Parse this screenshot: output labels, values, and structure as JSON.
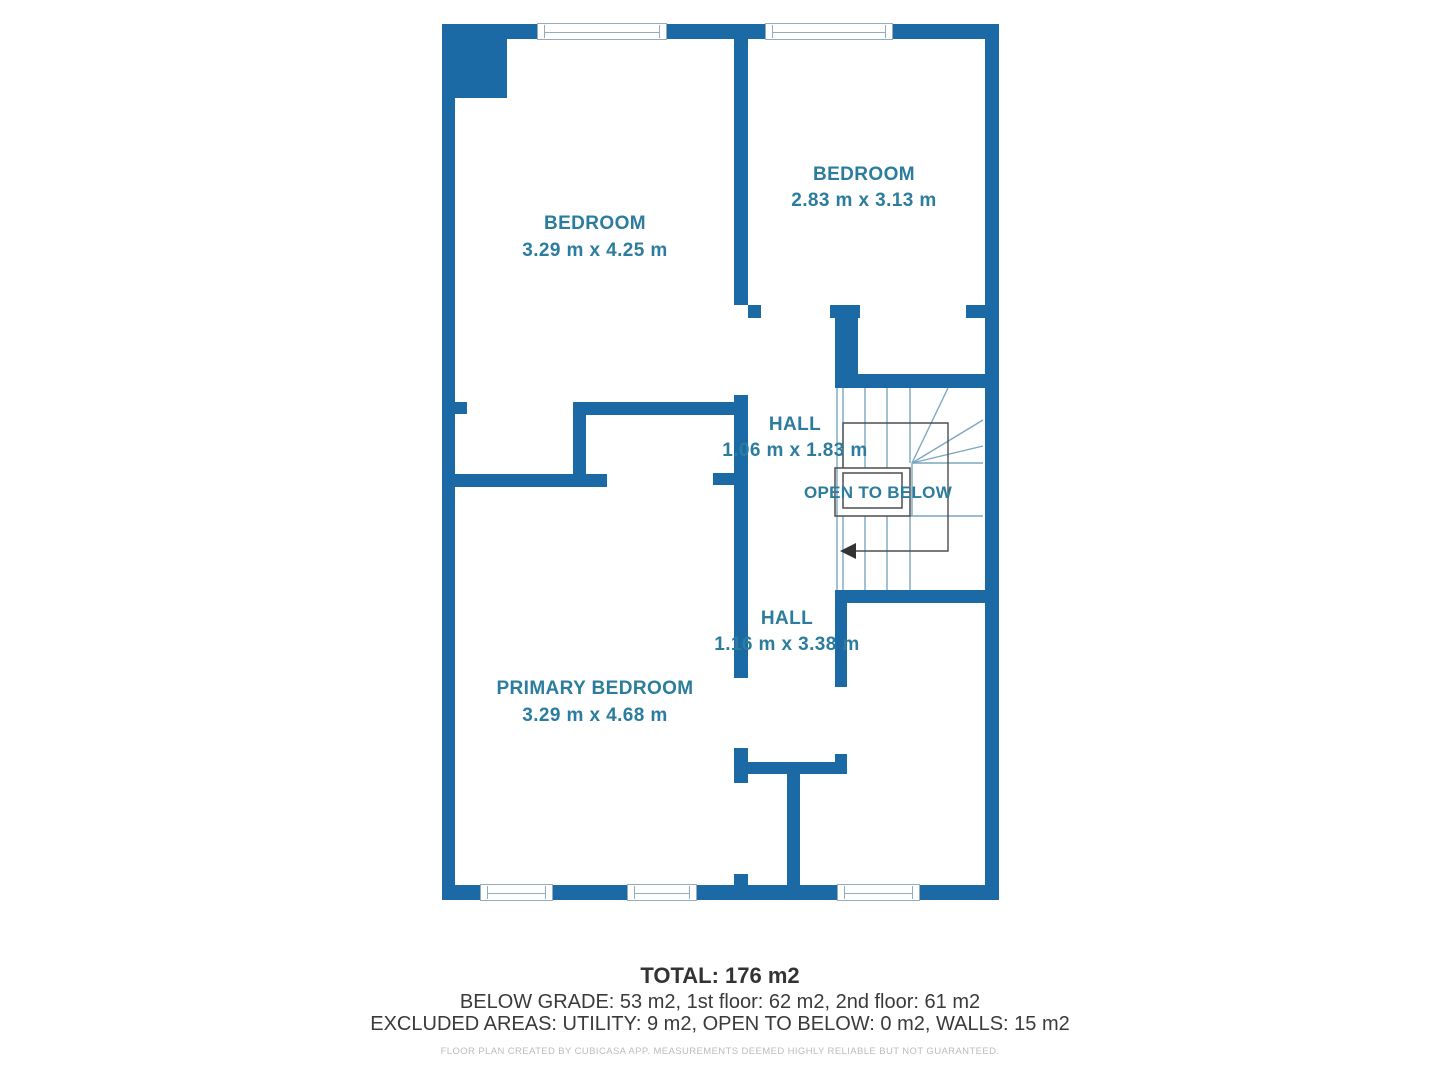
{
  "plan": {
    "rooms": [
      {
        "id": "bedroom-left",
        "name": "BEDROOM",
        "dims": "3.29 m x 4.25 m"
      },
      {
        "id": "bedroom-right",
        "name": "BEDROOM",
        "dims": "2.83 m x 3.13 m"
      },
      {
        "id": "hall-upper",
        "name": "HALL",
        "dims": "1.06 m x 1.83 m"
      },
      {
        "id": "hall-lower",
        "name": "HALL",
        "dims": "1.16 m x 3.38 m"
      },
      {
        "id": "primary-bedroom",
        "name": "PRIMARY BEDROOM",
        "dims": "3.29 m x 4.68 m"
      }
    ],
    "annotations": {
      "open_to_below": "OPEN TO BELOW"
    }
  },
  "footer": {
    "total": "TOTAL: 176 m2",
    "floors": "BELOW GRADE: 53 m2, 1st floor: 62 m2, 2nd floor: 61 m2",
    "excluded": "EXCLUDED AREAS: UTILITY: 9 m2, OPEN TO BELOW: 0 m2, WALLS: 15 m2",
    "disclaimer": "FLOOR PLAN CREATED BY CUBICASA APP. MEASUREMENTS DEEMED HIGHLY RELIABLE BUT NOT GUARANTEED."
  },
  "colors": {
    "wall": "#1b6aa5",
    "room_label": "#2b7c9d",
    "stair_line": "#7ba7c1",
    "detail_line": "#4d4d4d",
    "window_line": "#93adbc",
    "footer_text": "#333333",
    "disclaimer_text": "#bcbcbc"
  }
}
